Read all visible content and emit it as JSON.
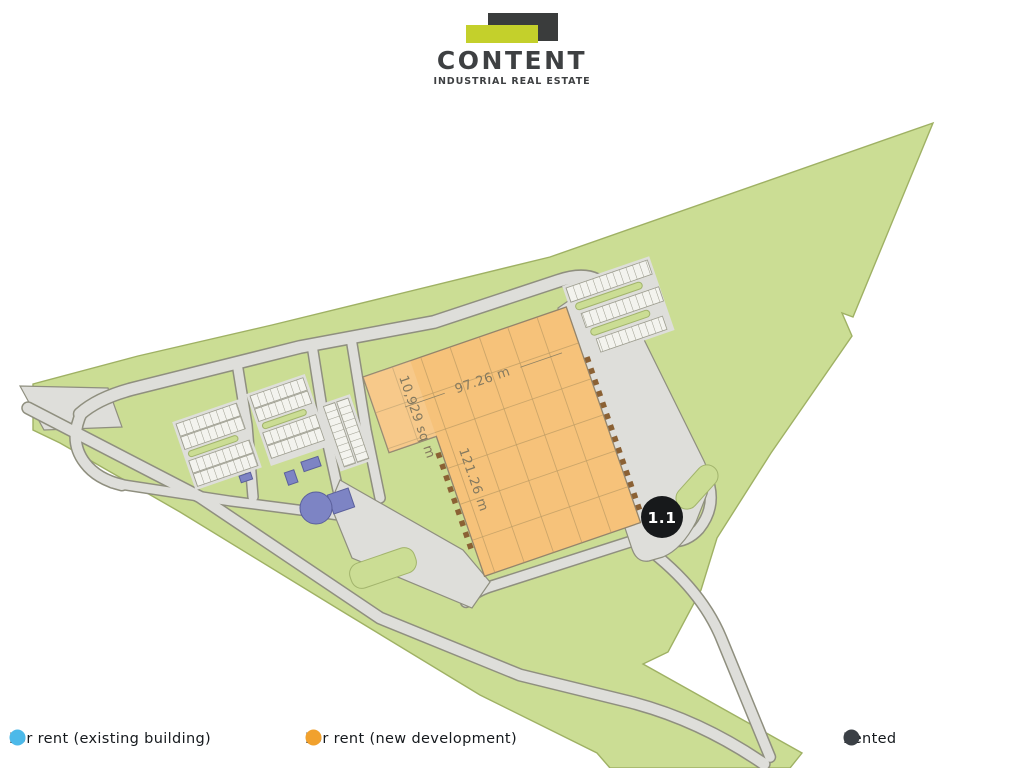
{
  "logo": {
    "name": "CONTENT",
    "tagline": "INDUSTRIAL REAL ESTATE"
  },
  "plan": {
    "unit": {
      "id_label": "1.1",
      "top_dimension": "97.26 m",
      "area": "10,929 sq m",
      "side_dimension": "121.26 m",
      "fill": "#f6c27a",
      "status": "for rent (new development)"
    },
    "land_fill": "#cbdd94",
    "road_fill": "#dededa"
  },
  "legend": {
    "items": [
      {
        "label": "For rent (existing building)",
        "color": "#4cb9e9"
      },
      {
        "label": "For rent (new development)",
        "color": "#f1a12d"
      },
      {
        "label": "Rented",
        "color": "#3b4046"
      }
    ]
  }
}
